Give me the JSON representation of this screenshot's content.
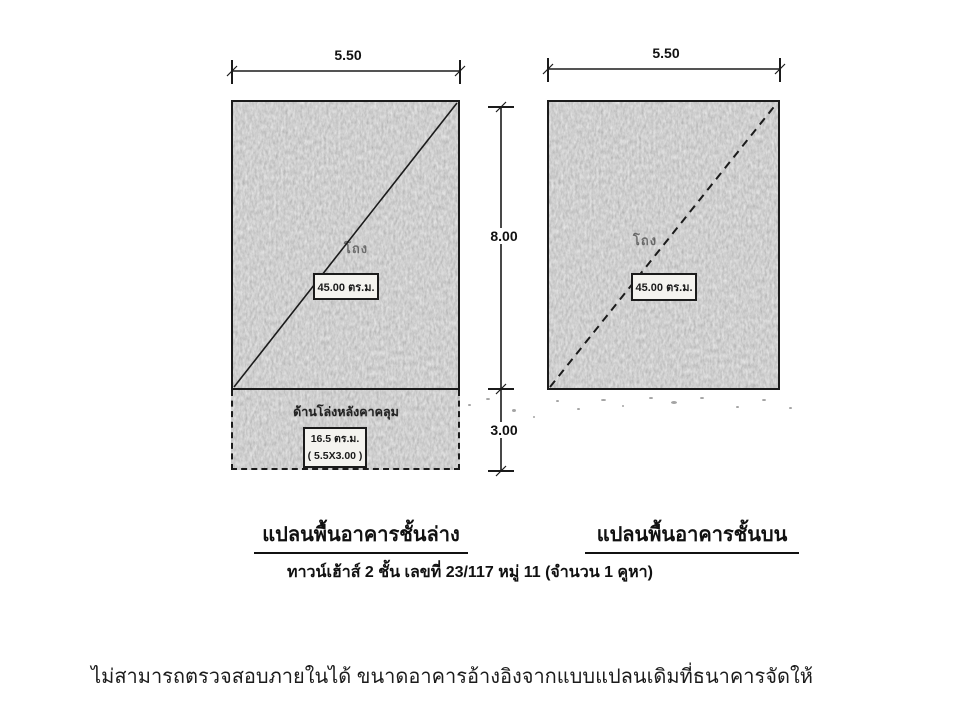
{
  "document": {
    "subtitle": "ทาวน์เฮ้าส์ 2 ชั้น  เลขที่ 23/117 หมู่ 11  (จำนวน 1 คูหา)",
    "bottom_note": "ไม่สามารถตรวจสอบภายในได้ ขนาดอาคารอ้างอิงจากแบบแปลนเดิมที่ธนาคารจัดให้"
  },
  "dimensions": {
    "lower_width": "5.50",
    "upper_width": "5.50",
    "main_height": "8.00",
    "annex_height": "3.00"
  },
  "lower_plan": {
    "caption": "แปลนพื้นอาคารชั้นล่าง",
    "hall_label": "โถง",
    "area_label": "45.00 ตร.ม.",
    "annex_title": "ด้านโล่งหลังคาคลุม",
    "annex_area": "16.5 ตร.ม.",
    "annex_size": "( 5.5X3.00 )"
  },
  "upper_plan": {
    "caption": "แปลนพื้นอาคารชั้นบน",
    "hall_label": "โถง",
    "area_label": "45.00 ตร.ม."
  },
  "colors": {
    "paper": "#ffffff",
    "ink": "#1b1b1b",
    "plan_fill": "#a3a3a3"
  }
}
